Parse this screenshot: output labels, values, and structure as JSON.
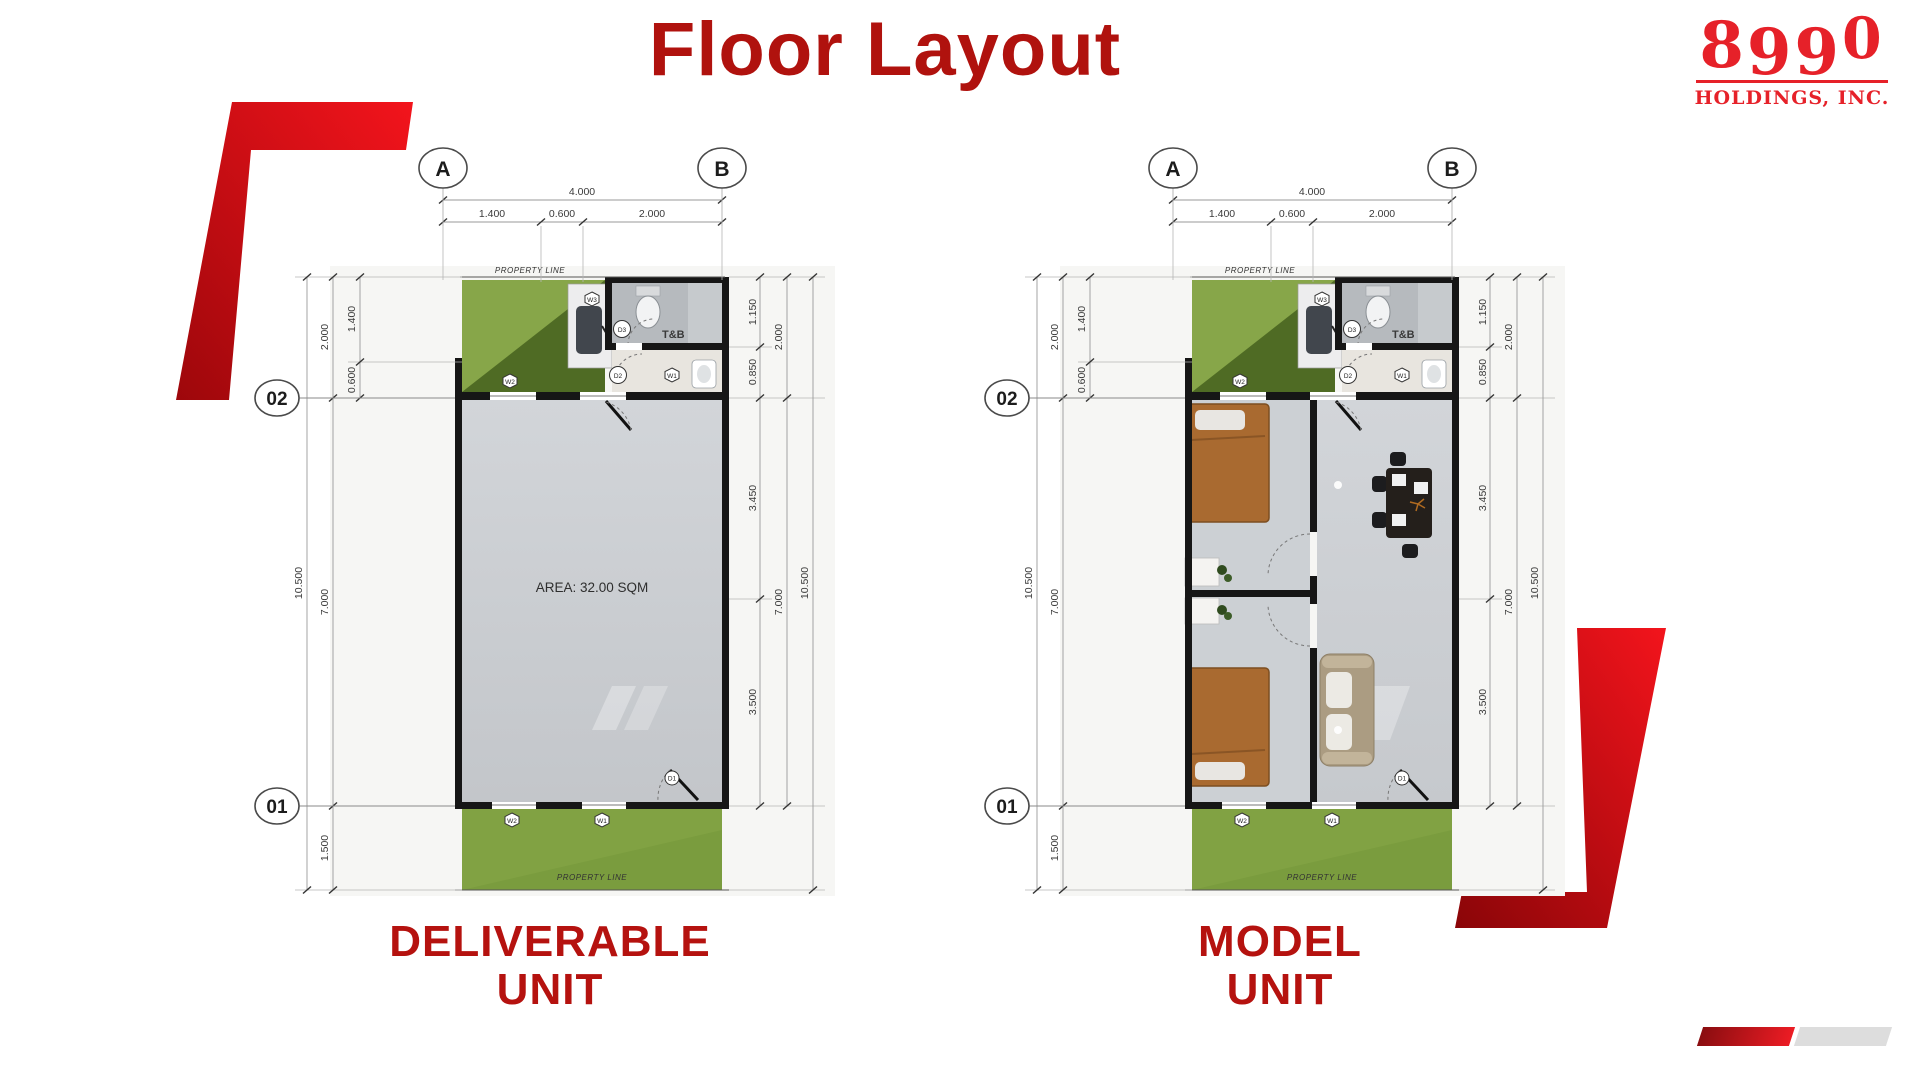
{
  "slide": {
    "title": "Floor Layout"
  },
  "logo": {
    "d1": "8",
    "d2": "9",
    "d3": "9",
    "d4": "0",
    "subtitle": "HOLDINGS, INC."
  },
  "plans": [
    {
      "caption_line1": "DELIVERABLE",
      "caption_line2": "UNIT",
      "area_label": "AREA: 32.00 SQM"
    },
    {
      "caption_line1": "MODEL",
      "caption_line2": "UNIT"
    }
  ],
  "annotations": {
    "grid": {
      "col_a": "A",
      "col_b": "B",
      "row_top": "02",
      "row_bottom": "01"
    },
    "property_line": "PROPERTY LINE",
    "toilet_bath": "T&B",
    "dims": {
      "d4000": "4.000",
      "d1400": "1.400",
      "d0600": "0.600",
      "d2000": "2.000",
      "d1150": "1.150",
      "d0850": "0.850",
      "d3450": "3.450",
      "d3500": "3.500",
      "d7000": "7.000",
      "d10500": "10.500",
      "d1500": "1.500"
    },
    "tags": {
      "d1": "D1",
      "d2": "D2",
      "d3": "D3",
      "w1": "W1",
      "w2": "W2",
      "w3": "W3"
    }
  },
  "colors": {
    "title_red": "#B0120E",
    "caption_red": "#B5120F",
    "logo_red": "#E62129",
    "deco_bright": "#f3141c",
    "deco_dark": "#9d070b",
    "lawn_green": "#7a9c3e",
    "lawn_dark": "#4f6b24",
    "floor_gray": "#cdd0d4",
    "wall_black": "#161616"
  }
}
